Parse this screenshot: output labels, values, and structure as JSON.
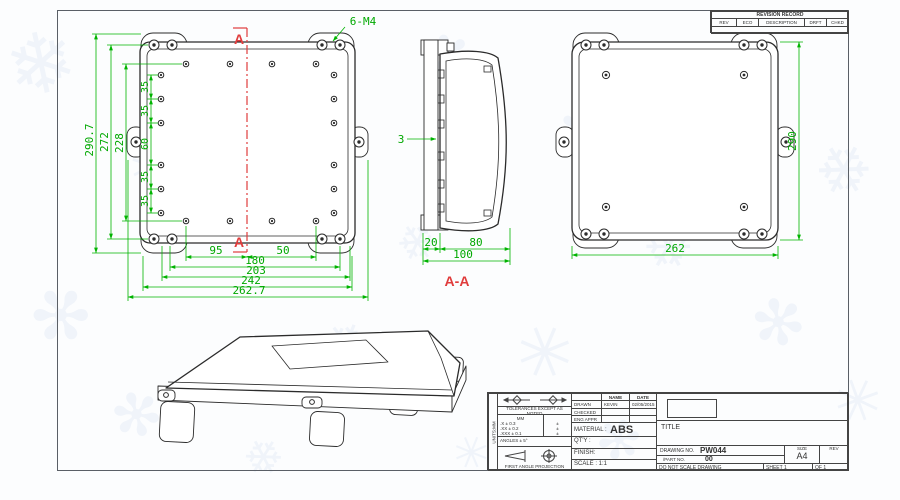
{
  "drawing": {
    "front": {
      "section_marker": "A",
      "thread_callout": "6-M4",
      "dims_vertical": [
        "290.7",
        "272",
        "228"
      ],
      "dims_chain_left": [
        "35",
        "35",
        "60",
        "35",
        "35"
      ],
      "dims_bottom": [
        "95",
        "50",
        "180",
        "203",
        "242",
        "262.7"
      ]
    },
    "section": {
      "label": "A-A",
      "dim_thickness": "3",
      "dims_bottom": [
        "20",
        "80",
        "100"
      ]
    },
    "back": {
      "dim_height": "290",
      "dim_width": "262"
    },
    "colors": {
      "dimension": "#00b300",
      "centerline": "#e03c3c",
      "line": "#2b2b2b"
    }
  },
  "revision_table": {
    "title": "REVISION RECORD",
    "headers": [
      "REV",
      "ECO",
      "DESCRIPTION",
      "DRFT",
      "CHKD"
    ]
  },
  "title_block": {
    "side_note": "UNITS:MM",
    "tolerance_note": "TOLERANCES EXCEPT AS NOTED",
    "tol_header": "MM",
    "tol_rows": [
      ".X ± 0.3",
      ".XX ± 0.2",
      ".XXX ± 0.1"
    ],
    "tol_marks": "±",
    "angles_note": "ANGLES ± 5°",
    "projection_note": "FIRST ANGLE PROJECTION",
    "name_header": "NAME",
    "date_header": "DATE",
    "drawn_label": "DRAWN",
    "drawn_name": "KEVIN",
    "drawn_date": "02/05/2015",
    "checked_label": "CHECKED",
    "eng_appr_label": "ENG APPR",
    "material_label": "MATERIAL :",
    "material_value": "ABS",
    "qty_label": "QT'Y :",
    "finish_label": "FINISH:",
    "scale_label": "SCALE : 1:1",
    "title_label": "TITLE",
    "drawing_no_label": "DRAWING NO.",
    "drawing_no_value": "PW044",
    "part_no_label": "/PART NO.",
    "part_no_value": "00",
    "size_label": "SIZE",
    "size_value": "A4",
    "rev_label": "REV",
    "no_scale_note": "DO NOT SCALE DRAWING",
    "sheet_label": "SHEET 1",
    "of_label": "OF 1"
  },
  "watermark": {
    "glyphs": [
      "❄",
      "✳",
      "✻"
    ]
  }
}
